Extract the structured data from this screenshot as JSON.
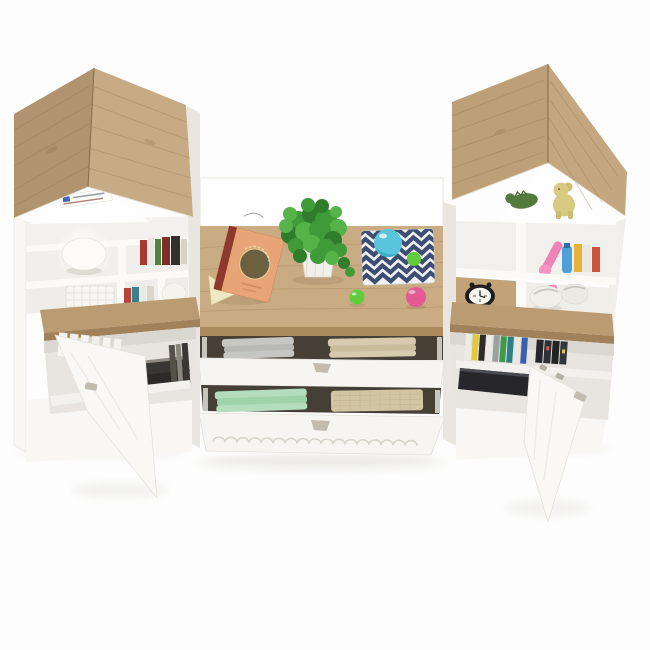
{
  "scene": {
    "type": "3d-product-render",
    "subject": "kids house-shaped bookcase wall unit with desk top, open drawers of folded clothes and two open doors",
    "objects": [
      "left-house-tower",
      "right-house-tower",
      "desk-top",
      "open-storybook",
      "potted-plant",
      "chevron-mat",
      "blue-ball-toy",
      "green-ball",
      "pink-ball",
      "dome-lamp",
      "wire-basket",
      "book-spines",
      "egg-vase",
      "alarm-clock",
      "plush-pair",
      "teddy-toy",
      "dino-toy",
      "gray-clothes",
      "beige-clothes",
      "mint-clothes",
      "magazine-files",
      "dark-storage-box",
      "open-door-left",
      "open-door-right",
      "label-sticker"
    ]
  },
  "colors": {
    "bg": "#fdfdfd",
    "shadow": "#e9e8e4",
    "roofL_left": "#b0936f",
    "roofL_right": "#c7ab84",
    "roofR_left": "#bda077",
    "roofR_right": "#c4a77e",
    "grain": "#8f7450",
    "desk_top": "#c9ac83",
    "desk_edge": "#ab8a5e",
    "shelf_wood": "#bb9b72",
    "shelf_wood_edge": "#a1815a",
    "panel_white": "#f8f7f4",
    "panel_bright": "#fefefe",
    "panel_gray": "#e9e6e1",
    "interior": "#f1efeb",
    "interior_dark": "#e8e5e0",
    "shelf_board": "#fbfaf7",
    "gap_dark": "#463f35",
    "drawer": "#f6f5f1",
    "handle": "#c2bcb0",
    "scallop": "#d8d4cb",
    "door": "#f9f8f5",
    "rail": "#c7c4be",
    "cloth_gray": "#c6c6c2",
    "cloth_gray2": "#b8b8b4",
    "cloth_beige": "#d6cbae",
    "cloth_beige2": "#cabd9c",
    "cloth_mint": "#b4ddbd",
    "cloth_mint2": "#9fd1aa",
    "cloth_tan": "#d2c5a2",
    "mat_white": "#f1f2f4",
    "mat_navy": "#3e4e72",
    "ball_blue": "#58c5dc",
    "ball_blue_dark": "#2f9fbd",
    "ball_green": "#62cc3c",
    "ball_pink": "#e45a92",
    "plant": "#3f9a38",
    "plant_dark": "#2f7c2a",
    "plant_light": "#55b34a",
    "pot": "#f2f0ea",
    "book_cover": "#e7a477",
    "book_spine_red": "#8c392c",
    "book_pages": "#f0e8c2",
    "book_motif": "#6b6140",
    "clock_body": "#1f1e1c",
    "clock_face": "#f5f5f2",
    "teddy": "#d8ca83",
    "dino": "#547a3c",
    "lamp": "#fcfbf8",
    "egg": "#f5f3ee",
    "basket": "#f7f6f2",
    "box_dark": "#27272b",
    "sticker_logo": "#3a6ab5",
    "sticker_line": "#9aa0a8"
  }
}
